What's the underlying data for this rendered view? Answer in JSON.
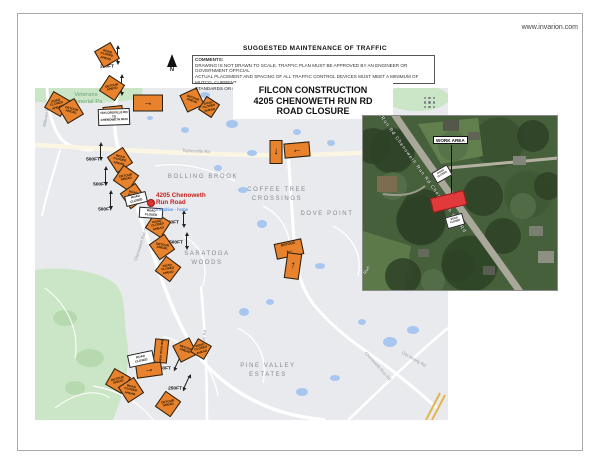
{
  "page": {
    "website": "www.invarion.com"
  },
  "header": {
    "plan_heading": "SUGGESTED MAINTENANCE OF TRAFFIC",
    "comments_label": "COMMENTS:",
    "comments_lines": [
      "DRAWING IS NOT DRAWN TO SCALE. TRAFFIC PLAN MUST BE APPROVED BY AN ENGINEER OR GOVERNMENT OFFICIAL",
      "ACTUAL PLACEMENT AND SPACING OF ALL TRAFFIC CONTROL DEVICES MUST MEET A MINIMUM OF MUTCD, CURRENT",
      "STANDARDS OR BE APPROVED BY AN ENGINEER"
    ],
    "title_lines": [
      "FILCON CONSTRUCTION",
      "4205 CHENOWETH RUN RD",
      "ROAD CLOSURE"
    ]
  },
  "compass": {
    "label": "N"
  },
  "map": {
    "area_labels": [
      {
        "text": "Veterans",
        "x": 86,
        "y": 95,
        "size": 5.5,
        "ls": 0.2,
        "color": "#6a9e77"
      },
      {
        "text": "Memorial Pa",
        "x": 86,
        "y": 102,
        "size": 5.5,
        "ls": 0.2,
        "color": "#6a9e77"
      },
      {
        "text": "BOLLING BROOK",
        "x": 203,
        "y": 177,
        "size": 6,
        "ls": 1.6,
        "color": "#838b92"
      },
      {
        "text": "COFFEE TREE",
        "x": 277,
        "y": 190,
        "size": 6,
        "ls": 1.6,
        "color": "#838b92"
      },
      {
        "text": "CROSSINGS",
        "x": 277,
        "y": 199,
        "size": 6,
        "ls": 1.6,
        "color": "#838b92"
      },
      {
        "text": "DOVE POINT",
        "x": 327,
        "y": 214,
        "size": 6,
        "ls": 1.6,
        "color": "#838b92"
      },
      {
        "text": "SARATOGA",
        "x": 207,
        "y": 254,
        "size": 6,
        "ls": 1.6,
        "color": "#838b92"
      },
      {
        "text": "WOODS",
        "x": 207,
        "y": 263,
        "size": 6,
        "ls": 1.6,
        "color": "#838b92"
      },
      {
        "text": "PINE VALLEY",
        "x": 268,
        "y": 366,
        "size": 6,
        "ls": 1.6,
        "color": "#838b92"
      },
      {
        "text": "ESTATES",
        "x": 268,
        "y": 375,
        "size": 6,
        "ls": 1.6,
        "color": "#838b92"
      }
    ],
    "street_labels": [
      {
        "text": "Taylorsville Rd",
        "x": 196,
        "y": 151,
        "rot": 3
      },
      {
        "text": "Billtown Rd",
        "x": 46,
        "y": 116,
        "rot": -80
      },
      {
        "text": "Chenoweth Run Rd",
        "x": 141,
        "y": 243,
        "rot": -72
      },
      {
        "text": "Easum Rd",
        "x": 204,
        "y": 340,
        "rot": -85
      },
      {
        "text": "Chenoweth Run Rd",
        "x": 378,
        "y": 366,
        "rot": 48
      },
      {
        "text": "Old Heady Rd",
        "x": 414,
        "y": 359,
        "rot": 30
      }
    ],
    "address": {
      "line1": "4205 Chenoweth",
      "line2": "Run Road",
      "sub": "min drive - home",
      "x": 156,
      "y": 193
    },
    "pin": {
      "x": 151,
      "y": 203
    },
    "devices": [
      {
        "kind": "diamond",
        "x": 107,
        "y": 55,
        "rot": 15,
        "text": "ROAD CLOSED AHEAD"
      },
      {
        "kind": "diamond",
        "x": 112,
        "y": 88,
        "rot": -12,
        "text": "DETOUR AHEAD"
      },
      {
        "kind": "diamond",
        "x": 57,
        "y": 104,
        "rot": -15,
        "text": "ROAD CLOSED AHEAD"
      },
      {
        "kind": "diamond",
        "x": 71,
        "y": 111,
        "rot": 14,
        "text": "DETOUR AHEAD"
      },
      {
        "kind": "diamond",
        "x": 192,
        "y": 100,
        "rot": 20,
        "text": "DETOUR AHEAD"
      },
      {
        "kind": "diamond",
        "x": 209,
        "y": 107,
        "rot": -12,
        "s": 16,
        "text": "ROAD CLOSED AHEAD"
      },
      {
        "kind": "diamond",
        "x": 120,
        "y": 160,
        "rot": 12,
        "text": "ROAD CLOSED AHEAD"
      },
      {
        "kind": "diamond",
        "x": 126,
        "y": 178,
        "rot": -10,
        "text": "DETOUR AHEAD"
      },
      {
        "kind": "diamond",
        "x": 133,
        "y": 196,
        "rot": 10,
        "text": "ROAD WORK AHEAD"
      },
      {
        "kind": "diamond",
        "x": 158,
        "y": 225,
        "rot": -12,
        "text": "ROAD CLOSED AHEAD"
      },
      {
        "kind": "diamond",
        "x": 162,
        "y": 247,
        "rot": 10,
        "text": "DETOUR AHEAD"
      },
      {
        "kind": "diamond",
        "x": 168,
        "y": 269,
        "rot": -8,
        "text": "ROAD CLOSED AHEAD"
      },
      {
        "kind": "diamond",
        "x": 185,
        "y": 350,
        "rot": 18,
        "text": "DETOUR AHEAD"
      },
      {
        "kind": "diamond",
        "x": 201,
        "y": 349,
        "rot": -15,
        "s": 16,
        "text": "ROAD CLOSED AHEAD"
      },
      {
        "kind": "diamond",
        "x": 118,
        "y": 381,
        "rot": -15,
        "text": "DETOUR AHEAD"
      },
      {
        "kind": "diamond",
        "x": 131,
        "y": 390,
        "rot": 12,
        "text": "ROAD CLOSED AHEAD"
      },
      {
        "kind": "diamond",
        "x": 168,
        "y": 404,
        "rot": -10,
        "text": "DETOUR AHEAD"
      },
      {
        "kind": "rect",
        "x": 148,
        "y": 103,
        "w": 30,
        "h": 17,
        "rot": 0,
        "arrow": "right"
      },
      {
        "kind": "rect",
        "x": 113,
        "y": 112,
        "w": 20,
        "h": 12,
        "rot": -6,
        "arrow": "right"
      },
      {
        "kind": "vrect",
        "x": 276,
        "y": 152,
        "w": 13,
        "h": 24,
        "rot": 0,
        "arrow": "down"
      },
      {
        "kind": "rect",
        "x": 297,
        "y": 150,
        "w": 26,
        "h": 15,
        "rot": -5,
        "arrow": "left"
      },
      {
        "kind": "rect",
        "x": 289,
        "y": 249,
        "w": 28,
        "h": 16,
        "rot": -12,
        "arrow": "left",
        "word": "DETOUR"
      },
      {
        "kind": "vrect",
        "x": 293,
        "y": 266,
        "w": 15,
        "h": 26,
        "rot": 8,
        "arrow": "up"
      },
      {
        "kind": "rect",
        "x": 149,
        "y": 370,
        "w": 26,
        "h": 14,
        "rot": -8,
        "arrow": "right"
      },
      {
        "kind": "vrect",
        "x": 161,
        "y": 351,
        "w": 14,
        "h": 24,
        "rot": 6,
        "vtext": "END ROAD WORK"
      },
      {
        "kind": "white",
        "x": 114,
        "y": 117,
        "w": 32,
        "h": 17,
        "rot": -2,
        "lines": [
          "TAYLORSVILLE RD",
          "TO",
          "CHENOWETH RUN"
        ]
      },
      {
        "kind": "white",
        "x": 136,
        "y": 199,
        "w": 22,
        "h": 11,
        "rot": -14,
        "lines": [
          "ROAD",
          "CLOSED"
        ]
      },
      {
        "kind": "white",
        "x": 151,
        "y": 213,
        "w": 24,
        "h": 11,
        "rot": 4,
        "lines": [
          "ROAD",
          "CLOSED"
        ]
      },
      {
        "kind": "white",
        "x": 141,
        "y": 359,
        "w": 26,
        "h": 13,
        "rot": -12,
        "lines": [
          "ROAD",
          "CLOSED"
        ]
      }
    ],
    "markers": [
      {
        "label": "250FT",
        "x": 107,
        "y": 67
      },
      {
        "label": "250FT",
        "x": 115,
        "y": 91
      },
      {
        "label": "500FT",
        "x": 93,
        "y": 160
      },
      {
        "label": "500FT",
        "x": 100,
        "y": 185
      },
      {
        "label": "500FT",
        "x": 105,
        "y": 210
      },
      {
        "label": "250FT",
        "x": 172,
        "y": 223
      },
      {
        "label": "500FT",
        "x": 176,
        "y": 243
      },
      {
        "label": "250FT",
        "x": 164,
        "y": 369
      },
      {
        "label": "250FT",
        "x": 175,
        "y": 389
      }
    ],
    "dimlines": [
      {
        "x": 117,
        "y": 48,
        "len": 14,
        "rot": 0
      },
      {
        "x": 121,
        "y": 77,
        "len": 16,
        "rot": 0
      },
      {
        "x": 100,
        "y": 145,
        "len": 13,
        "rot": 0
      },
      {
        "x": 105,
        "y": 169,
        "len": 14,
        "rot": 0
      },
      {
        "x": 110,
        "y": 193,
        "len": 14,
        "rot": 0
      },
      {
        "x": 183,
        "y": 213,
        "len": 12,
        "rot": 0
      },
      {
        "x": 186,
        "y": 235,
        "len": 12,
        "rot": 0
      },
      {
        "x": 177,
        "y": 356,
        "len": 13,
        "rot": 25
      },
      {
        "x": 186,
        "y": 376,
        "len": 13,
        "rot": 25
      }
    ]
  },
  "inset": {
    "work_area_label": "WORK AREA",
    "road_label": "Run Rd   Chenoweth Run Rd    Chenoweth Run Rd",
    "corner_label": "Run",
    "sign_lines": [
      "ROAD",
      "CLOSED"
    ],
    "signs": [
      {
        "x": 78,
        "y": 57,
        "rot": -30
      },
      {
        "x": 91,
        "y": 104,
        "rot": -16
      }
    ]
  }
}
